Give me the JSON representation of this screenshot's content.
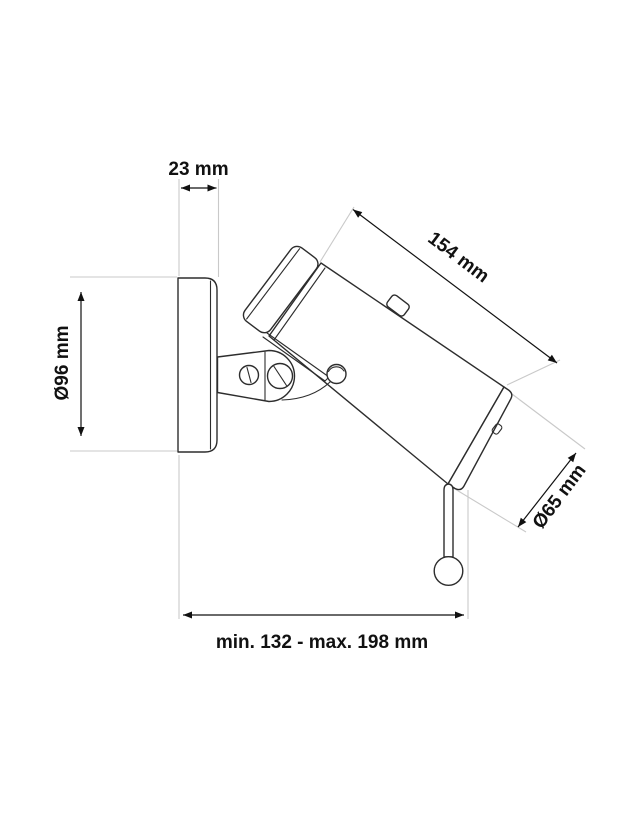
{
  "drawing": {
    "kind": "technical dimension drawing of a wall-mounted adjustable spotlight",
    "labels": {
      "plate_depth": "23 mm",
      "body_length": "154 mm",
      "plate_diameter": "Ø96 mm",
      "body_diameter": "Ø65 mm",
      "reach_range": "min. 132 - max. 198 mm"
    },
    "colors": {
      "background": "#ffffff",
      "outline": "#2d2d2d",
      "extension_line": "#c9c9c9",
      "dimension_line": "#111111",
      "text": "#111111"
    }
  }
}
